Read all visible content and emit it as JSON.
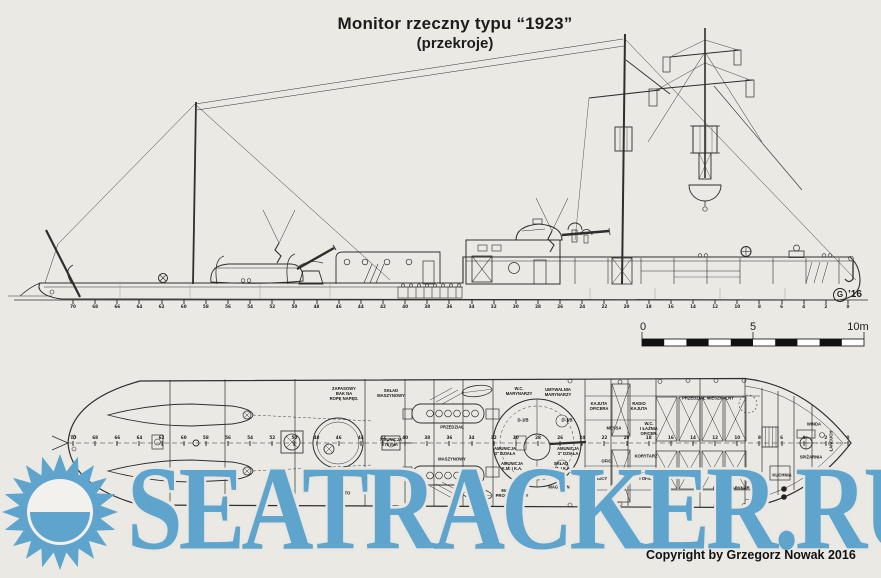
{
  "title": {
    "line1": "Monitor rzeczny typu “1923”",
    "line2": "(przekroje)"
  },
  "copyright": "Copyright by Grzegorz Nowak 2016",
  "artist_mark": {
    "initial": "G",
    "year": "’16"
  },
  "watermark": {
    "text": "SEATRACKER.RU",
    "color": "#5fa4cc"
  },
  "colors": {
    "paper": "#ebe9e4",
    "ink": "#2e2e2e",
    "watermark_blue": "#5fa4cc"
  },
  "scale_bar": {
    "unit": "m",
    "length_m": 10,
    "labels": [
      {
        "text": "0",
        "x": 643
      },
      {
        "text": "5",
        "x": 753
      },
      {
        "text": "10m",
        "x": 858
      }
    ]
  },
  "frames": {
    "numbers": [
      70,
      68,
      66,
      64,
      62,
      60,
      58,
      56,
      54,
      52,
      50,
      48,
      46,
      44,
      42,
      40,
      38,
      36,
      34,
      32,
      30,
      28,
      26,
      24,
      22,
      20,
      18,
      16,
      14,
      12,
      10,
      8,
      6,
      4,
      2,
      0
    ]
  },
  "plan_labels": [
    {
      "text": "ZAPASOWY\nBAK NA\nROPĘ NAPĘD.",
      "x": 344,
      "y": 394
    },
    {
      "text": "SKŁAD\nMASZYNOWY",
      "x": 391,
      "y": 394
    },
    {
      "text": "PRZEDZIAŁ",
      "x": 452,
      "y": 428
    },
    {
      "text": "MASZYNOWY",
      "x": 452,
      "y": 460
    },
    {
      "text": "AMUNICJA\n75 mm",
      "x": 391,
      "y": 443
    },
    {
      "text": "AMUNICJA\n3\" DZIAŁA",
      "x": 505,
      "y": 452
    },
    {
      "text": "AMUNICJA\n3\" DZIAŁA",
      "x": 568,
      "y": 452
    },
    {
      "text": "AMUNICJA\nK.M. I K.A.",
      "x": 512,
      "y": 467
    },
    {
      "text": "SKŁAD\nK.M. I K.A.",
      "x": 561,
      "y": 467
    },
    {
      "text": "D-1/B",
      "x": 523,
      "y": 421
    },
    {
      "text": "D-1/B",
      "x": 567,
      "y": 421
    },
    {
      "text": "MAGAZYN\nPROWIANTOWY",
      "x": 512,
      "y": 494
    },
    {
      "text": "MAGAZYN",
      "x": 559,
      "y": 488
    },
    {
      "text": "W.C.\nMARYNARZY",
      "x": 519,
      "y": 392
    },
    {
      "text": "UMYWALNIA\nMARYNARZY",
      "x": 558,
      "y": 393
    },
    {
      "text": "KAJUTA\nOFICERA",
      "x": 599,
      "y": 407
    },
    {
      "text": "RADIO\nKAJUTA",
      "x": 639,
      "y": 407
    },
    {
      "text": "MESSA",
      "x": 614,
      "y": 429
    },
    {
      "text": "W.C.\nI ŁAŹNIA\nOFICER.",
      "x": 649,
      "y": 429
    },
    {
      "text": "OFIC.",
      "x": 607,
      "y": 462
    },
    {
      "text": "KORYTARZ",
      "x": 646,
      "y": 457
    },
    {
      "text": "KAJUTA\nDOWÓDCY",
      "x": 596,
      "y": 477
    },
    {
      "text": "KAJUTA\nI OFICERA",
      "x": 650,
      "y": 477
    },
    {
      "text": "PRZEDZIAŁ MIESZKALNY",
      "x": 708,
      "y": 399
    },
    {
      "text": "DLA 24 MARYNARZY",
      "x": 734,
      "y": 489
    },
    {
      "text": "KUCHNIA",
      "x": 782,
      "y": 476
    },
    {
      "text": "WINDA",
      "x": 814,
      "y": 425
    },
    {
      "text": "SPIŻARNIA",
      "x": 811,
      "y": 458
    },
    {
      "text": "ŁAŃCUCH",
      "x": 832,
      "y": 441,
      "rot": -90
    },
    {
      "text": "D-TTO",
      "x": 344,
      "y": 494
    },
    {
      "text": "D-TTO",
      "x": 386,
      "y": 494
    }
  ]
}
